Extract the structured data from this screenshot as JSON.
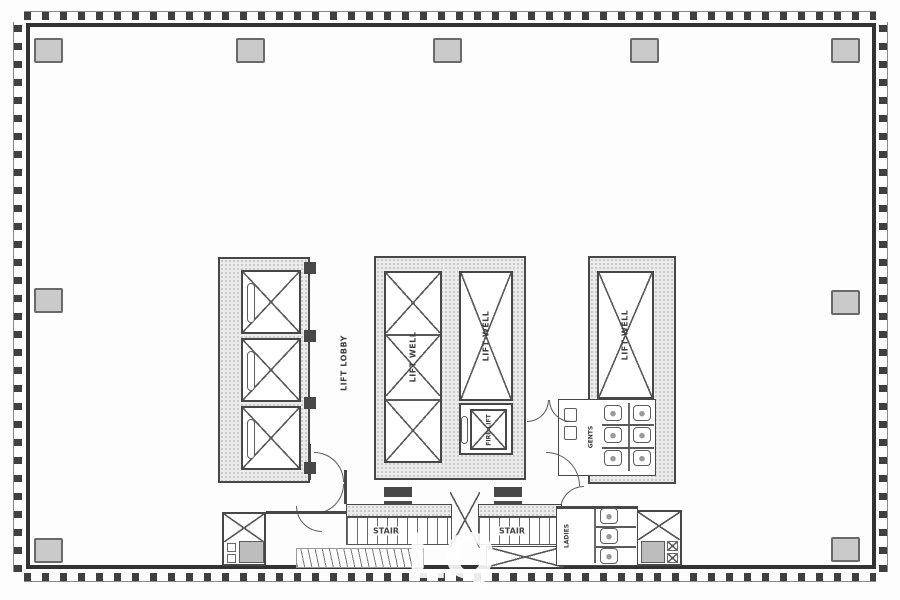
{
  "labels": {
    "lift_lobby": "LIFT LOBBY",
    "lift_well": "LIFT WELL",
    "fire_lift": "FIRE LIFT",
    "stair": "STAIR",
    "gents": "GENTS",
    "ladies": "LADIES"
  },
  "watermark": "LQ",
  "colors": {
    "wall": "#474747",
    "stipple_fill": "#ebebeb",
    "column_fill": "#cacaca",
    "floor": "#ffffff",
    "watermark_text": "#ffffff"
  }
}
